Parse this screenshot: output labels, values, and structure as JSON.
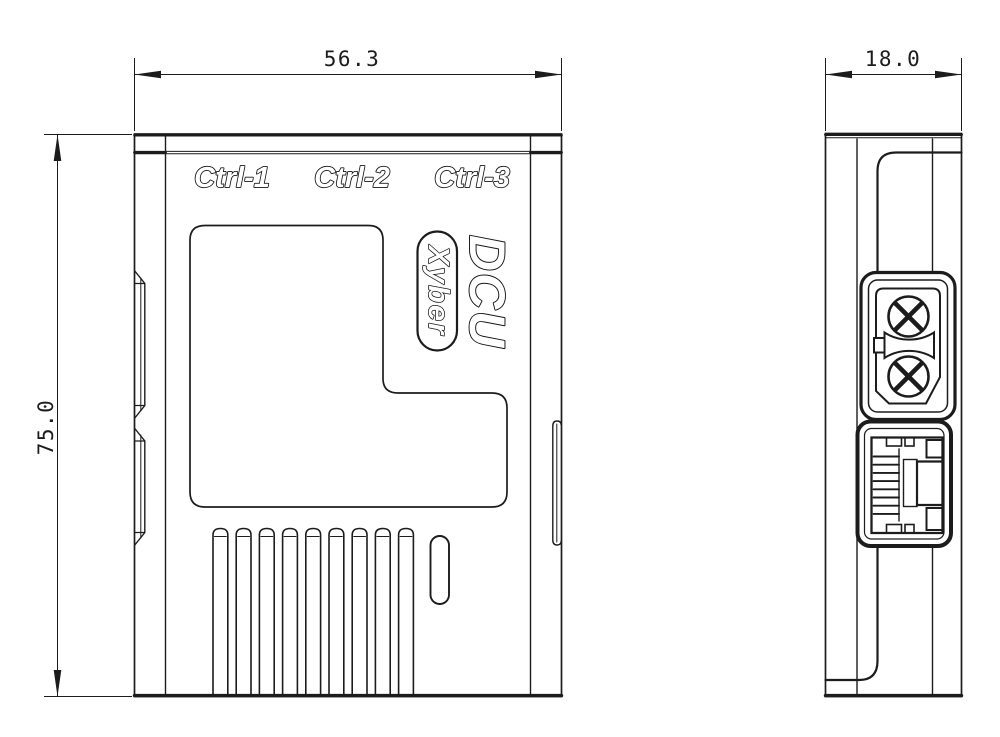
{
  "front_view": {
    "port_labels": [
      "Ctrl-1",
      "Ctrl-2",
      "Ctrl-3"
    ],
    "product_name": "DCU",
    "brand": "Xyber",
    "width_dim": "56.3",
    "height_dim": "75.0"
  },
  "side_view": {
    "depth_dim": "18.0"
  },
  "colors": {
    "line": "#1c1c1c",
    "background": "#ffffff"
  }
}
